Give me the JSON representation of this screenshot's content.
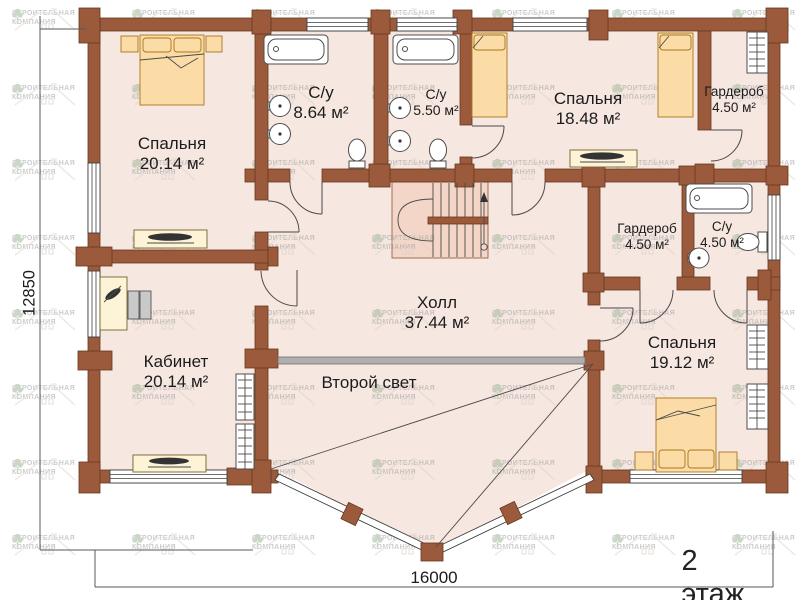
{
  "watermark": {
    "line1": "СТРОИТЕЛЬНАЯ",
    "line2": "КОМПАНИЯ"
  },
  "rooms": [
    {
      "id": "bedroom1",
      "name": "Спальня",
      "area": "20.14 м²"
    },
    {
      "id": "bath1",
      "name": "С/у",
      "area": "8.64 м²"
    },
    {
      "id": "bath2",
      "name": "С/у",
      "area": "5.50 м²"
    },
    {
      "id": "bedroom2",
      "name": "Спальня",
      "area": "18.48 м²"
    },
    {
      "id": "wardrobe1",
      "name": "Гардероб",
      "area": "4.50 м²"
    },
    {
      "id": "wardrobe2",
      "name": "Гардероб",
      "area": "4.50 м²"
    },
    {
      "id": "bath3",
      "name": "С/у",
      "area": "4.50 м²"
    },
    {
      "id": "bedroom3",
      "name": "Спальня",
      "area": "19.12 м²"
    },
    {
      "id": "hall",
      "name": "Холл",
      "area": "37.44 м²"
    },
    {
      "id": "office",
      "name": "Кабинет",
      "area": "20.14 м²"
    },
    {
      "id": "secondlight",
      "name": "Второй свет",
      "area": ""
    }
  ],
  "dimensions": {
    "height": "12850",
    "width": "16000"
  },
  "floor_label": "2 этаж",
  "colors": {
    "wall": "#9c5a3d",
    "wall_outline": "#67381f",
    "floor": "#f6e7e1",
    "stair": "#f3d6c7",
    "furniture": "#fbdca6",
    "railing": "#b0aeae"
  }
}
